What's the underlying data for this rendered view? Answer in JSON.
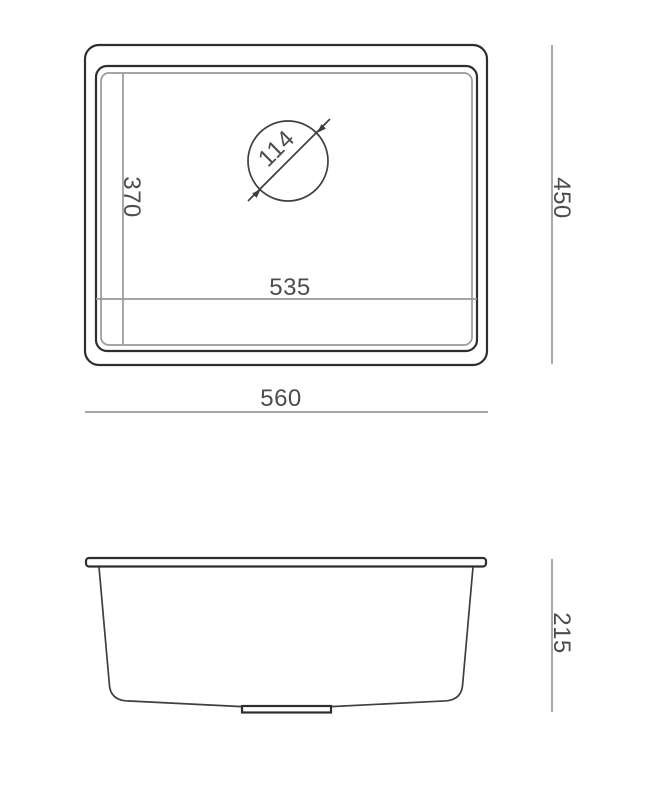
{
  "drawing_type": "sink-dimension-drawing",
  "dimensions": {
    "top_view": {
      "overall_width": "560",
      "overall_depth": "450",
      "bowl_width": "535",
      "bowl_depth": "370",
      "drain_diameter": "114"
    },
    "side_view": {
      "height": "215"
    }
  },
  "colors": {
    "background": "#ffffff",
    "outline_dark": "#2e2e2e",
    "outline_medium": "#3f3f3f",
    "dimension_line": "#999999",
    "dimension_text": "#4d4d4d"
  }
}
